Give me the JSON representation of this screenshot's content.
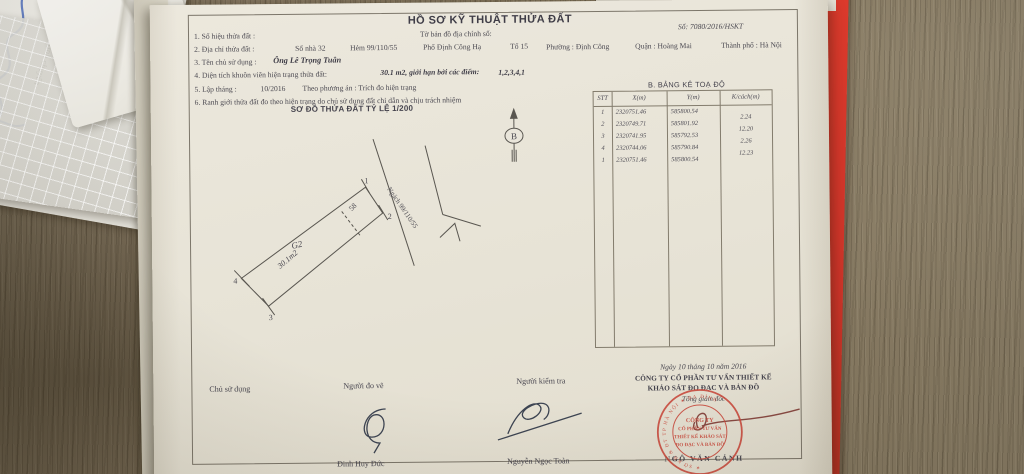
{
  "doc": {
    "number": "Số: 7080/2016/HSKT",
    "title": "HỒ SƠ KỸ THUẬT THỬA ĐẤT",
    "map_sheet_label": "Tờ bản đồ địa chính số:",
    "line1_label": "1. Số hiệu thửa đất :",
    "line2": {
      "label": "2. Địa chỉ thửa đất :",
      "house_no": "Số nhà 32",
      "alley": "Hẻm 99/110/55",
      "street": "Phố Định Công Hạ",
      "group": "Tổ 15",
      "ward": "Phường : Định Công",
      "district": "Quận : Hoàng Mai",
      "city": "Thành phố : Hà Nội"
    },
    "line3": {
      "label": "3. Tên chủ sử dụng :",
      "value": "Ông Lê Trọng Tuân"
    },
    "line4": {
      "label": "4. Diện tích khuôn viên hiện trạng thửa đất:",
      "value": "30.1 m2, giới hạn bởi các điểm:",
      "points": "1,2,3,4,1"
    },
    "line5": {
      "label": "5. Lập tháng :",
      "value": "10/2016",
      "method": "Theo phương án : Trích đo hiện trạng"
    },
    "line6": "6. Ranh giới thửa đất đo theo hiện trạng do chủ sử dụng đất chỉ dẫn và chịu trách nhiệm"
  },
  "diagram": {
    "title": "SƠ ĐỒ THỬA ĐẤT TỶ LỆ 1/200",
    "alley_label": "Ngách 99/110/55",
    "house_label": "58",
    "block_label": "G2",
    "area_label": "30.1m2",
    "north_label": "B",
    "p1": "1",
    "p2": "2",
    "p3": "3",
    "p4": "4"
  },
  "coord_table": {
    "title": "B. BẢNG KÊ TOẠ ĐỘ",
    "headers": {
      "stt": "STT",
      "x": "X(m)",
      "y": "Y(m)",
      "d": "K/cách(m)"
    },
    "rows": [
      {
        "stt": "1",
        "x": "2320751.46",
        "y": "585800.54"
      },
      {
        "stt": "2",
        "x": "2320749.71",
        "y": "585801.92"
      },
      {
        "stt": "3",
        "x": "2320741.95",
        "y": "585792.53"
      },
      {
        "stt": "4",
        "x": "2320744.06",
        "y": "585790.84"
      },
      {
        "stt": "1",
        "x": "2320751.46",
        "y": "585800.54"
      }
    ],
    "distances": [
      "2.24",
      "12.20",
      "2.26",
      "12.23"
    ]
  },
  "signatures": {
    "owner_label": "Chủ sử dụng",
    "surveyor_label": "Người đo vẽ",
    "surveyor_name": "Đinh Huy Đức",
    "checker_label": "Người kiểm tra",
    "checker_name": "Nguyễn Ngọc Toàn",
    "date": "Ngày 10 tháng 10 năm 2016",
    "company_line1": "CÔNG TY CỔ PHẦN TƯ VẤN THIẾT KẾ",
    "company_line2": "KHẢO SÁT ĐO ĐẠC VÀ BẢN ĐỒ",
    "director_title": "Tổng giám đốc",
    "director_name": "NGÔ VĂN CẢNH"
  },
  "stamp": {
    "line1": "CÔNG TY",
    "line2": "CỔ PHẦN TƯ VẤN",
    "line3": "THIẾT KẾ KHẢO SÁT",
    "line4": "ĐO ĐẠC VÀ BẢN ĐỒ",
    "ring_text": "✶ SỞ KH & ĐT TP HÀ NỘI ✶ BA ĐÌNH"
  },
  "background": {
    "side_text1": "tranh chấp, thể",
    "side_text2": "rong quá trình chuyển"
  }
}
